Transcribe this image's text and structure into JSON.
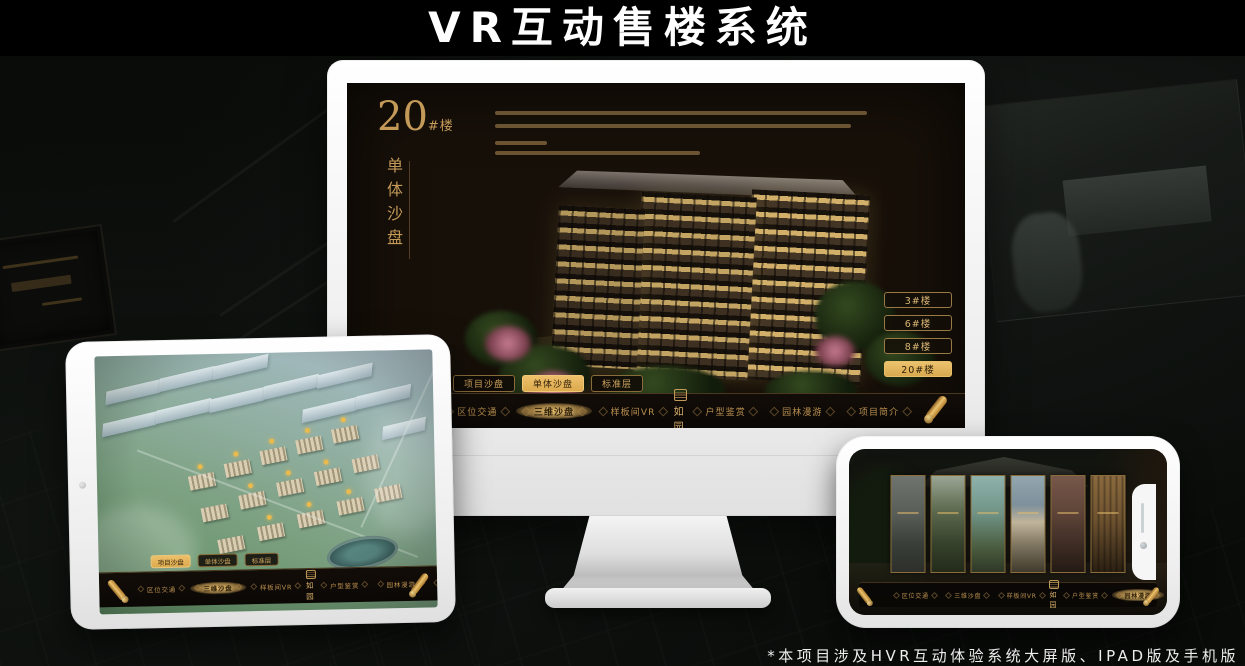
{
  "title": "VR互动售楼系统",
  "footnote": "*本项目涉及HVR互动体验系统大屏版、IPAD版及手机版",
  "brand": {
    "logo_text": "如园"
  },
  "colors": {
    "gold": "#c9a15f",
    "gold_bright": "#eec06a",
    "screen_bg": "#171009"
  },
  "monitor": {
    "headline": {
      "number": "20",
      "suffix": "#楼",
      "vertical_label": "单体沙盘"
    },
    "building_buttons": [
      {
        "label": "3#楼",
        "selected": false
      },
      {
        "label": "6#楼",
        "selected": false
      },
      {
        "label": "8#楼",
        "selected": false
      },
      {
        "label": "20#楼",
        "selected": true
      }
    ],
    "view_tabs": [
      {
        "label": "项目沙盘",
        "selected": false
      },
      {
        "label": "单体沙盘",
        "selected": true
      },
      {
        "label": "标准层",
        "selected": false
      }
    ],
    "nav": {
      "selected_index": 1,
      "items": [
        {
          "label": "区位交通",
          "selected": false
        },
        {
          "label": "三维沙盘",
          "selected": true
        },
        {
          "label": "样板间VR",
          "selected": false
        },
        {
          "label": "户型鉴赏",
          "selected": false
        },
        {
          "label": "园林漫游",
          "selected": false
        },
        {
          "label": "项目简介",
          "selected": false
        }
      ]
    }
  },
  "tablet": {
    "view_tabs": [
      {
        "label": "项目沙盘",
        "selected": true
      },
      {
        "label": "单体沙盘",
        "selected": false
      },
      {
        "label": "标准层",
        "selected": false
      }
    ],
    "nav": {
      "selected_index": 1,
      "items": [
        {
          "label": "区位交通",
          "selected": false
        },
        {
          "label": "三维沙盘",
          "selected": true
        },
        {
          "label": "样板间VR",
          "selected": false
        },
        {
          "label": "户型鉴赏",
          "selected": false
        },
        {
          "label": "园林漫游",
          "selected": false
        },
        {
          "label": "项目简介",
          "selected": false
        }
      ]
    }
  },
  "phone": {
    "nav": {
      "selected_index": 4,
      "items": [
        {
          "label": "区位交通",
          "selected": false
        },
        {
          "label": "三维沙盘",
          "selected": false
        },
        {
          "label": "样板间VR",
          "selected": false
        },
        {
          "label": "户型鉴赏",
          "selected": false
        },
        {
          "label": "园林漫游",
          "selected": true
        },
        {
          "label": "项目简介",
          "selected": false
        }
      ]
    }
  }
}
